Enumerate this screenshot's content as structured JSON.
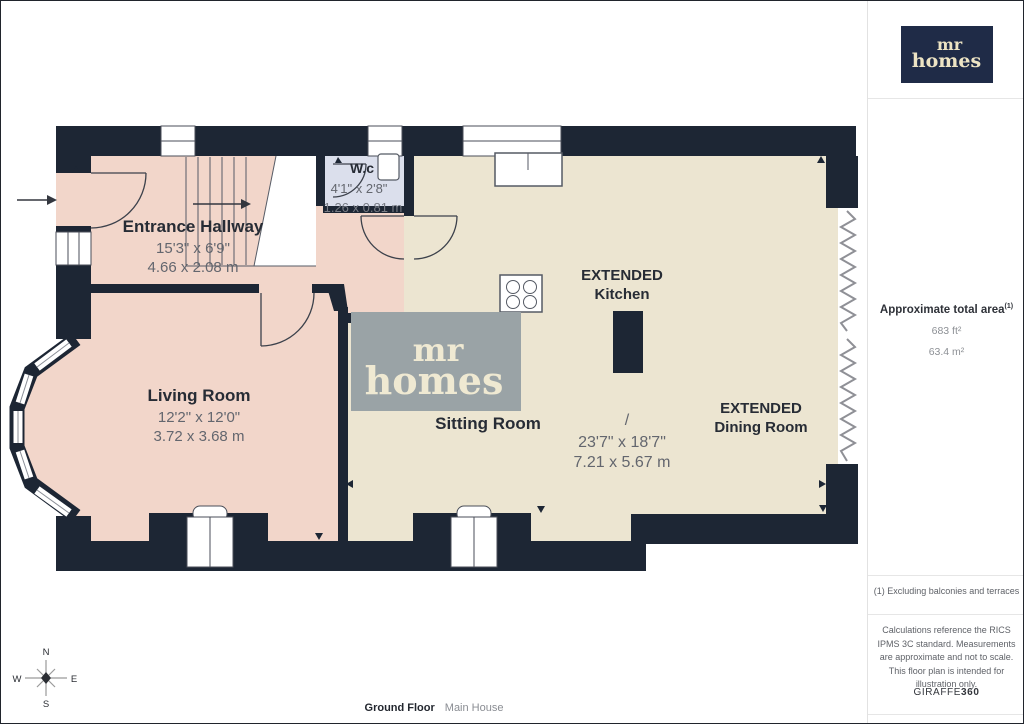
{
  "plan": {
    "entrance_hallway": {
      "name": "Entrance Hallway",
      "imperial": "15'3\" x 6'9\"",
      "metric": "4.66 x 2.08 m"
    },
    "wc": {
      "name": "W.c",
      "imperial": "4'1\" x 2'8\"",
      "metric": "1.26 x 0.81 m"
    },
    "living_room": {
      "name": "Living Room",
      "imperial": "12'2\" x 12'0\"",
      "metric": "3.72 x 3.68 m"
    },
    "sitting_room": {
      "name": "Sitting Room"
    },
    "kitchen": {
      "line1": "EXTENDED",
      "line2": "Kitchen"
    },
    "dining_room": {
      "line1": "EXTENDED",
      "line2": "Dining Room"
    },
    "open_plan": {
      "separator": "/",
      "imperial": "23'7\" x 18'7\"",
      "metric": "7.21 x 5.67 m"
    }
  },
  "watermark": {
    "line1": "mr",
    "line2": "homes"
  },
  "compass": {
    "north": "N",
    "east": "E",
    "south": "S",
    "west": "W"
  },
  "footer": {
    "floor": "Ground Floor",
    "house": "Main House"
  },
  "sidebar": {
    "logo": {
      "line1": "mr",
      "line2": "homes"
    },
    "area": {
      "title": "Approximate total area",
      "superscript": "(1)",
      "imperial": "683 ft²",
      "metric": "63.4 m²"
    },
    "footnote": "(1) Excluding balconies and terraces",
    "disclaimer": "Calculations reference the RICS IPMS 3C standard. Measurements are approximate and not to scale. This floor plan is intended for illustration only.",
    "brand": {
      "name": "GIRAFFE",
      "suffix": "360"
    }
  },
  "colors": {
    "wall": "#1d2634",
    "room_pink": "#f2d6ca",
    "room_cream": "#ece5d1",
    "wc_blue": "#dbdfec",
    "watermark_bg": "#9aa3a6",
    "watermark_text": "#efe9d2",
    "logo_navy": "#1f2b47",
    "logo_text": "#ede4c4"
  }
}
